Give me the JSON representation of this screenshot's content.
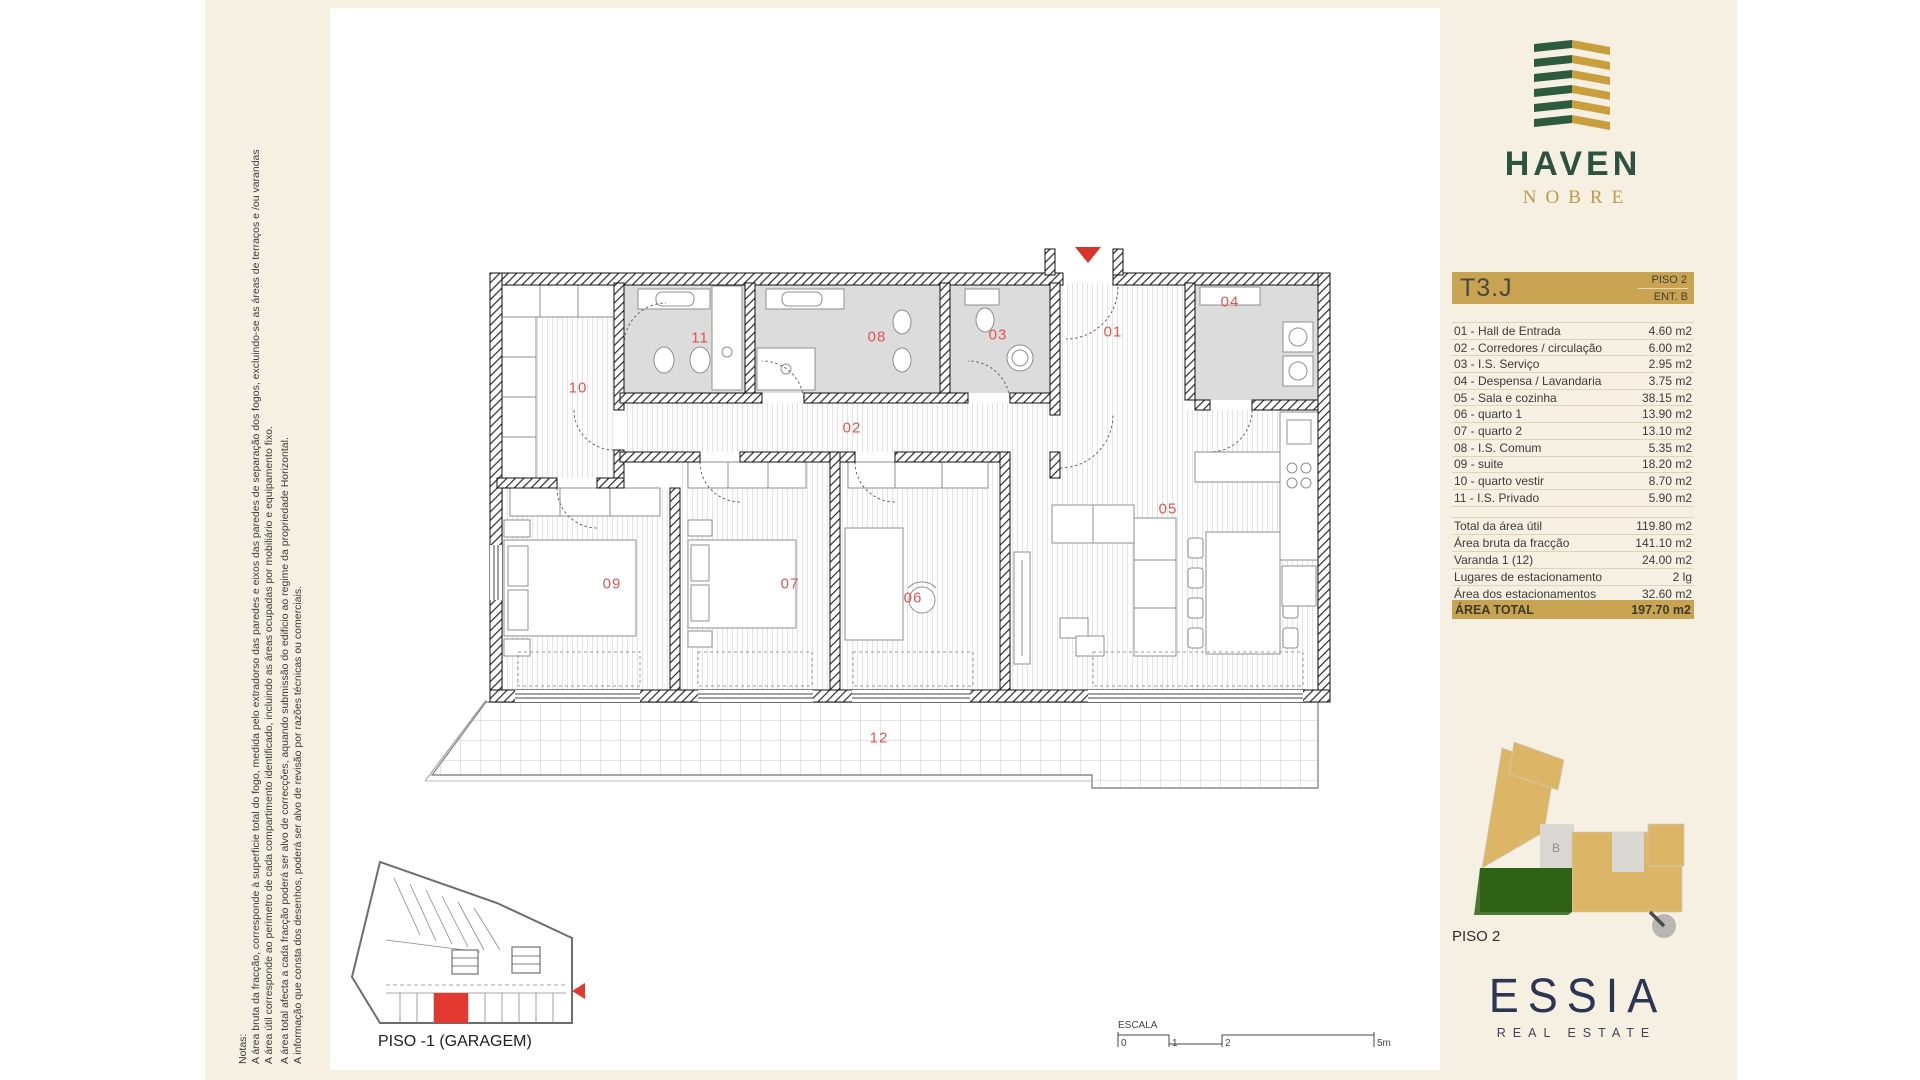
{
  "notes": {
    "title": "Notas:",
    "lines": [
      "A área bruta da fracção, corresponde à superficie total do fogo, medida pelo extradorso das paredes e eixos das paredes de separação dos fogos, excluindo-se as áreas de terraços e /ou varandas",
      "A área útil corresponde ao perimetro de cada compartimento identificado, incluindo as áreas ocupadas por mobiliário e equipamento fixo.",
      "A área total afecta a cada fracção poderá ser alvo de correcções, aquando submissão do edificio ao regime da propriedade Horizontal.",
      "A informação que consta dos desenhos, poderá ser alvo de revisão por razões técnicas ou comerciais."
    ]
  },
  "brand": {
    "name": "HAVEN",
    "sub": "NOBRE"
  },
  "unit": {
    "code": "T3.J",
    "floor": "PISO 2",
    "entrance": "ENT. B"
  },
  "rooms": [
    {
      "label": "01 - Hall de Entrada",
      "area": "4.60 m2"
    },
    {
      "label": "02 - Corredores / circulação",
      "area": "6.00 m2"
    },
    {
      "label": "03 - I.S. Serviço",
      "area": "2.95 m2"
    },
    {
      "label": "04 - Despensa / Lavandaria",
      "area": "3.75 m2"
    },
    {
      "label": "05 - Sala e cozinha",
      "area": "38.15 m2"
    },
    {
      "label": "06 - quarto 1",
      "area": "13.90 m2"
    },
    {
      "label": "07 - quarto 2",
      "area": "13.10 m2"
    },
    {
      "label": "08 - I.S. Comum",
      "area": "5.35 m2"
    },
    {
      "label": "09 - suite",
      "area": "18.20 m2"
    },
    {
      "label": "10 - quarto vestir",
      "area": "8.70 m2"
    },
    {
      "label": "11 - I.S. Privado",
      "area": "5.90 m2"
    }
  ],
  "summary": [
    {
      "label": "Total da área útil",
      "value": "119.80 m2"
    },
    {
      "label": "Área bruta da fracção",
      "value": "141.10 m2"
    },
    {
      "label": "Varanda 1 (12)",
      "value": "24.00 m2"
    },
    {
      "label": "Lugares de estacionamento",
      "value": "2 lg"
    },
    {
      "label": "Área dos estacionamentos",
      "value": "32.60 m2"
    }
  ],
  "total": {
    "label": "ÁREA TOTAL",
    "value": "197.70 m2"
  },
  "plan_labels": [
    {
      "n": "01",
      "x": 1113,
      "y": 332
    },
    {
      "n": "02",
      "x": 852,
      "y": 428
    },
    {
      "n": "03",
      "x": 998,
      "y": 335
    },
    {
      "n": "04",
      "x": 1230,
      "y": 302
    },
    {
      "n": "05",
      "x": 1168,
      "y": 509
    },
    {
      "n": "06",
      "x": 913,
      "y": 598
    },
    {
      "n": "07",
      "x": 790,
      "y": 584
    },
    {
      "n": "08",
      "x": 877,
      "y": 337
    },
    {
      "n": "09",
      "x": 612,
      "y": 584
    },
    {
      "n": "10",
      "x": 578,
      "y": 388
    },
    {
      "n": "11",
      "x": 700,
      "y": 338
    },
    {
      "n": "12",
      "x": 879,
      "y": 738
    }
  ],
  "keyplan": {
    "floor_label": "PISO 2",
    "unit_letter": "B"
  },
  "garage": {
    "label": "PISO -1 (GARAGEM)"
  },
  "scalebar": {
    "label": "ESCALA",
    "ticks": [
      "0",
      "1",
      "2",
      "5m"
    ]
  },
  "footer_brand": {
    "name": "ESSIA",
    "sub": "REAL ESTATE"
  },
  "colors": {
    "green": "#2d5340",
    "gold": "#c8a452",
    "navy": "#2c3553",
    "red": "#df5550",
    "cream": "#f6f0e3"
  }
}
